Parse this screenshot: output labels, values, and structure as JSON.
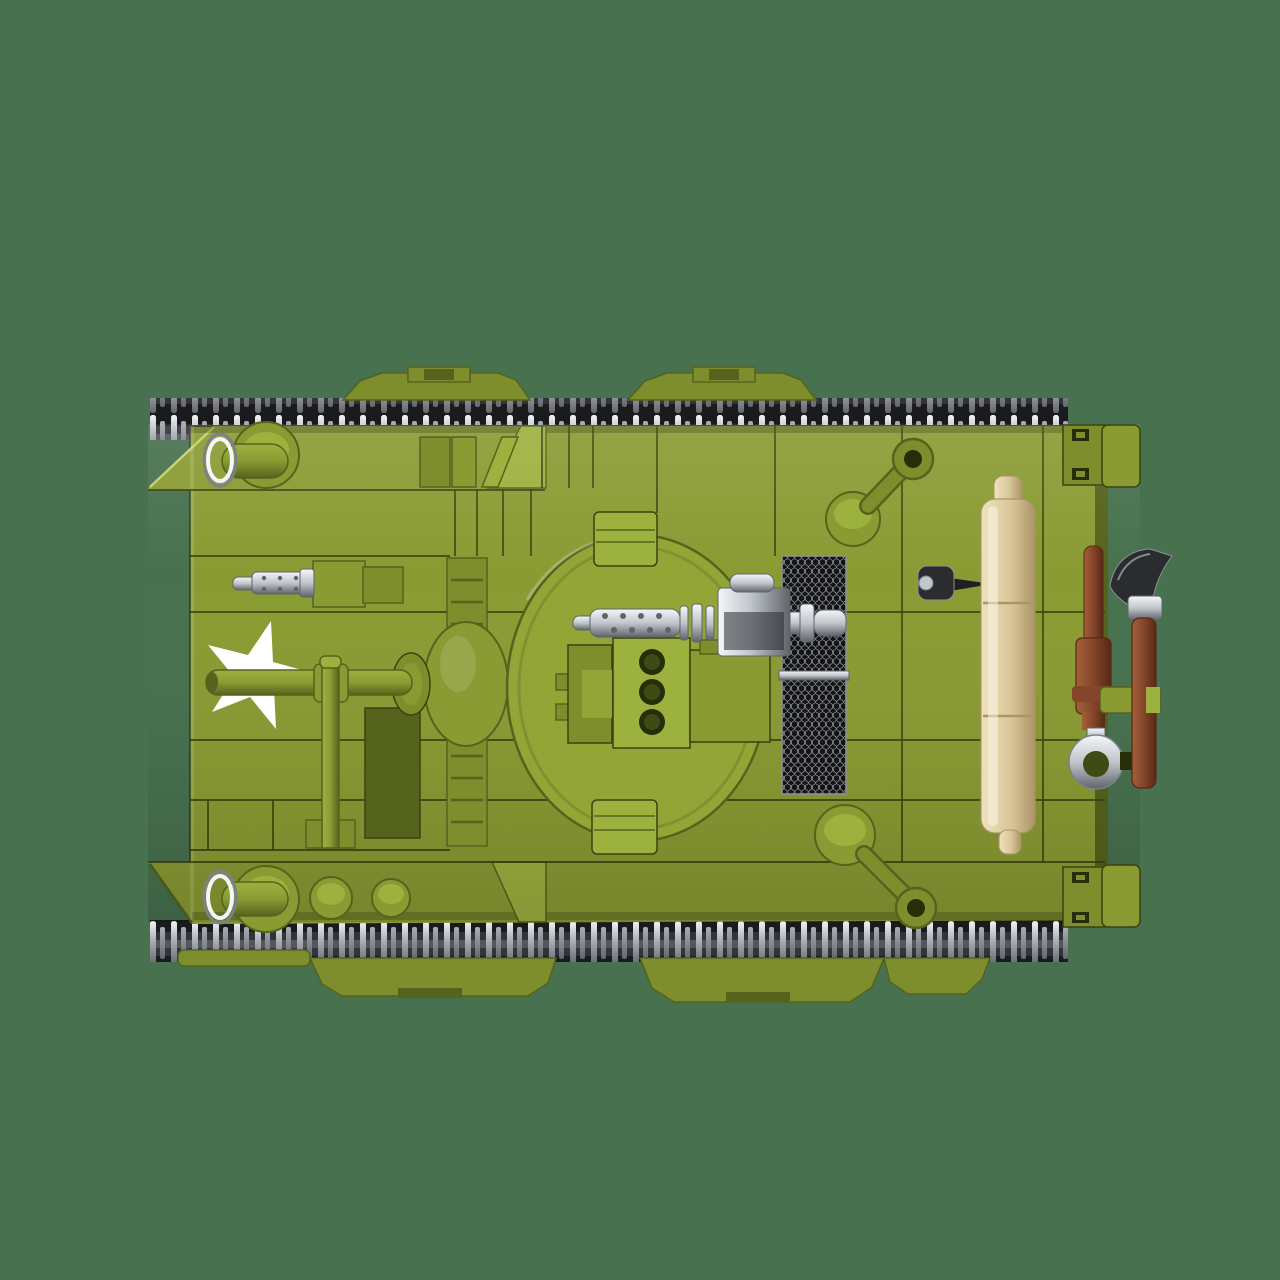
{
  "scene": {
    "type": "product-photo",
    "subject": "brick-built toy military tank",
    "view": "top-down",
    "facing": "front toward left",
    "visible_text": "none"
  },
  "colors": {
    "bg": "#47714F",
    "olive": "#8A9B33",
    "olive_turret": "#93A537",
    "olive_light": "#9DB13F",
    "olive_hi": "#C3D06A",
    "olive_mid": "#7E8E2C",
    "olive_dark": "#55631C",
    "olive_deep": "#3F4A14",
    "line": "#39430F",
    "hole": "#262E09",
    "track_base": "#1B1B1E",
    "track_link": "#33333A",
    "track_bar": "#55555C",
    "pin_light": "#F2F4F6",
    "pin_mid": "#A9AEB5",
    "pin_dark": "#63676D",
    "chrome_light": "#F4F6F8",
    "chrome_mid": "#C0C6CC",
    "chrome_dark": "#5F646A",
    "silver_dark": "#7C8187",
    "mesh_bg": "#141416",
    "mesh_line": "#9BA1A7",
    "tan_light": "#EFE2BB",
    "tan": "#D9C79B",
    "tan_dark": "#AB9468",
    "brown_light": "#A35F38",
    "brown": "#84452A",
    "brown_dark": "#562916",
    "black_part": "#2B2C2F",
    "black_hi": "#8E9296",
    "white": "#FFFFFF"
  },
  "parts": {
    "hull": "olive green brick hull, top view",
    "tracks": "dark track links with silver end pins (top and bottom)",
    "suspension_bogies": "green bogie covers peeking beyond tracks",
    "turret_ring": "large circular turret plate, center",
    "star_marking": "white five-pointed star on front-left deck",
    "main_gun": "green main gun barrel with cross brace, pointing left",
    "bow_machine_gun": "small chrome machine gun on left hull",
    "turret_machine_gun": "chrome perforated machine gun on turret",
    "engine_grilles": "two black mesh intake grilles right of turret",
    "headlights": "guarded bullet headlights on both fenders",
    "fuel_caps": "round green filler caps",
    "idler_cranks": "green crank arms with eyelet rings",
    "bedroll": "tan rolled tarp on rear deck",
    "tow_ring": "chrome towing eyelet with brown handle",
    "pickaxe": "black-headed tool with brown handle clipped to rear",
    "toggle_lever": "small black lever near rear deck"
  }
}
